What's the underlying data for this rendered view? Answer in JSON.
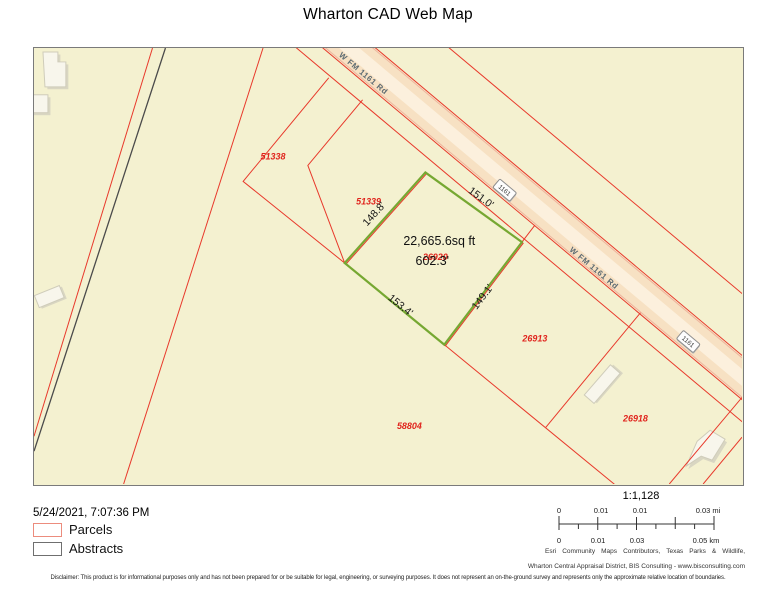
{
  "title": "Wharton CAD Web Map",
  "map": {
    "road": {
      "name": "W FM 1161 Rd",
      "shield": "1161"
    },
    "parcel_ids": [
      "51338",
      "51339",
      "26920",
      "26913",
      "26918",
      "58804"
    ],
    "selected": {
      "area": "22,665.6sq ft",
      "perimeter": "602.3'",
      "sides": [
        "148.8'",
        "151.0'",
        "153.4'",
        "149.1'"
      ]
    },
    "colors": {
      "background": "#f4f1d0",
      "parcel_line": "#e8392b",
      "abstract_line": "#4a4a4a",
      "selected_outline": "#76a832",
      "road_fill": "#f7e1c3",
      "building_fill": "#f8f6ec"
    }
  },
  "footer": {
    "timestamp": "5/24/2021, 7:07:36 PM",
    "legend": [
      {
        "label": "Parcels"
      },
      {
        "label": "Abstracts"
      }
    ],
    "scale": {
      "ratio": "1:1,128",
      "mi": [
        "0",
        "0.01",
        "0.01",
        "0.03 mi"
      ],
      "km": [
        "0",
        "0.01",
        "0.03",
        "0.05 km"
      ]
    },
    "attribution": [
      "Esri Community Maps Contributors, Texas Parks & Wildlife,",
      "Wharton Central Appraisal District, BIS Consulting - www.bisconsulting.com"
    ],
    "disclaimer": "Disclaimer: This product is for informational purposes only and has not been prepared for or be suitable for legal, engineering, or surveying purposes. It does not represent an on-the-ground survey and represents only the approximate relative location of boundaries."
  }
}
